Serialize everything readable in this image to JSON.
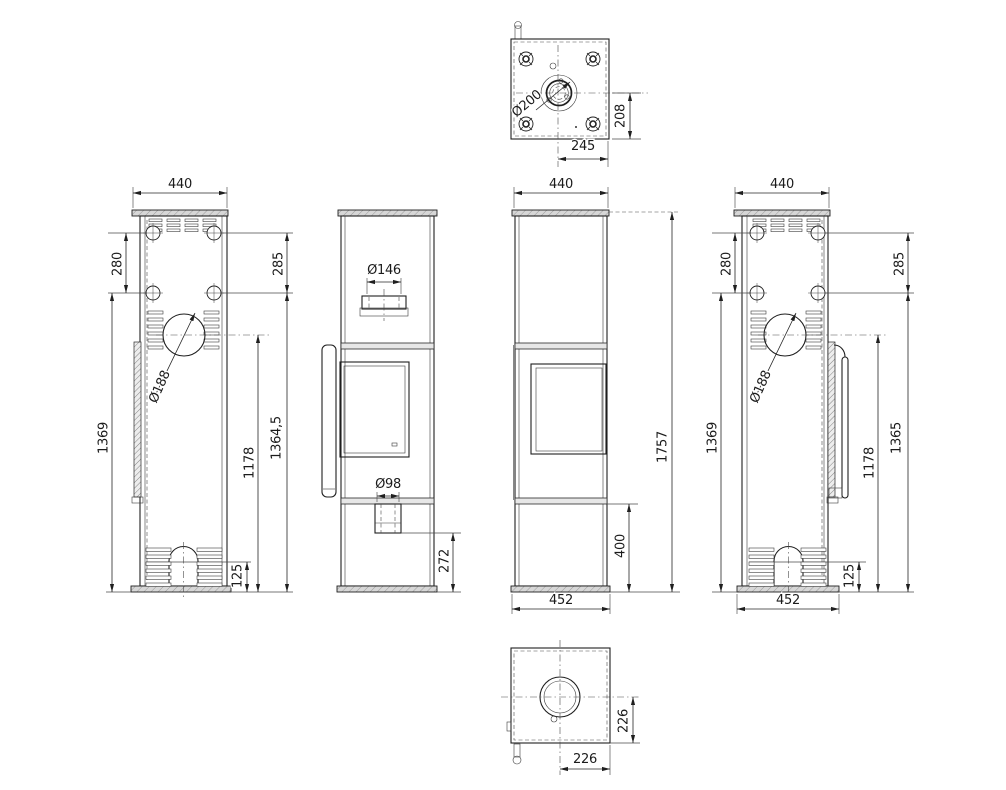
{
  "drawing": {
    "top_view": {
      "dia200": "Ø200",
      "dim208": "208",
      "dim245": "245"
    },
    "left_view": {
      "dim440": "440",
      "dim280": "280",
      "dim285": "285",
      "dim1369": "1369",
      "dim1178": "1178",
      "dim1364_5": "1364,5",
      "dim125": "125",
      "dia188": "Ø188"
    },
    "front_view": {
      "dia146": "Ø146",
      "dia98": "Ø98",
      "dim272": "272"
    },
    "side_view": {
      "dim440": "440",
      "dim1757": "1757",
      "dim400": "400",
      "dim452": "452"
    },
    "right_view": {
      "dim440": "440",
      "dim280": "280",
      "dim285": "285",
      "dim1369": "1369",
      "dim1178": "1178",
      "dim1365": "1365",
      "dim125": "125",
      "dim452": "452",
      "dia188": "Ø188"
    },
    "bottom_view": {
      "dim226_v": "226",
      "dim226_h": "226"
    }
  }
}
